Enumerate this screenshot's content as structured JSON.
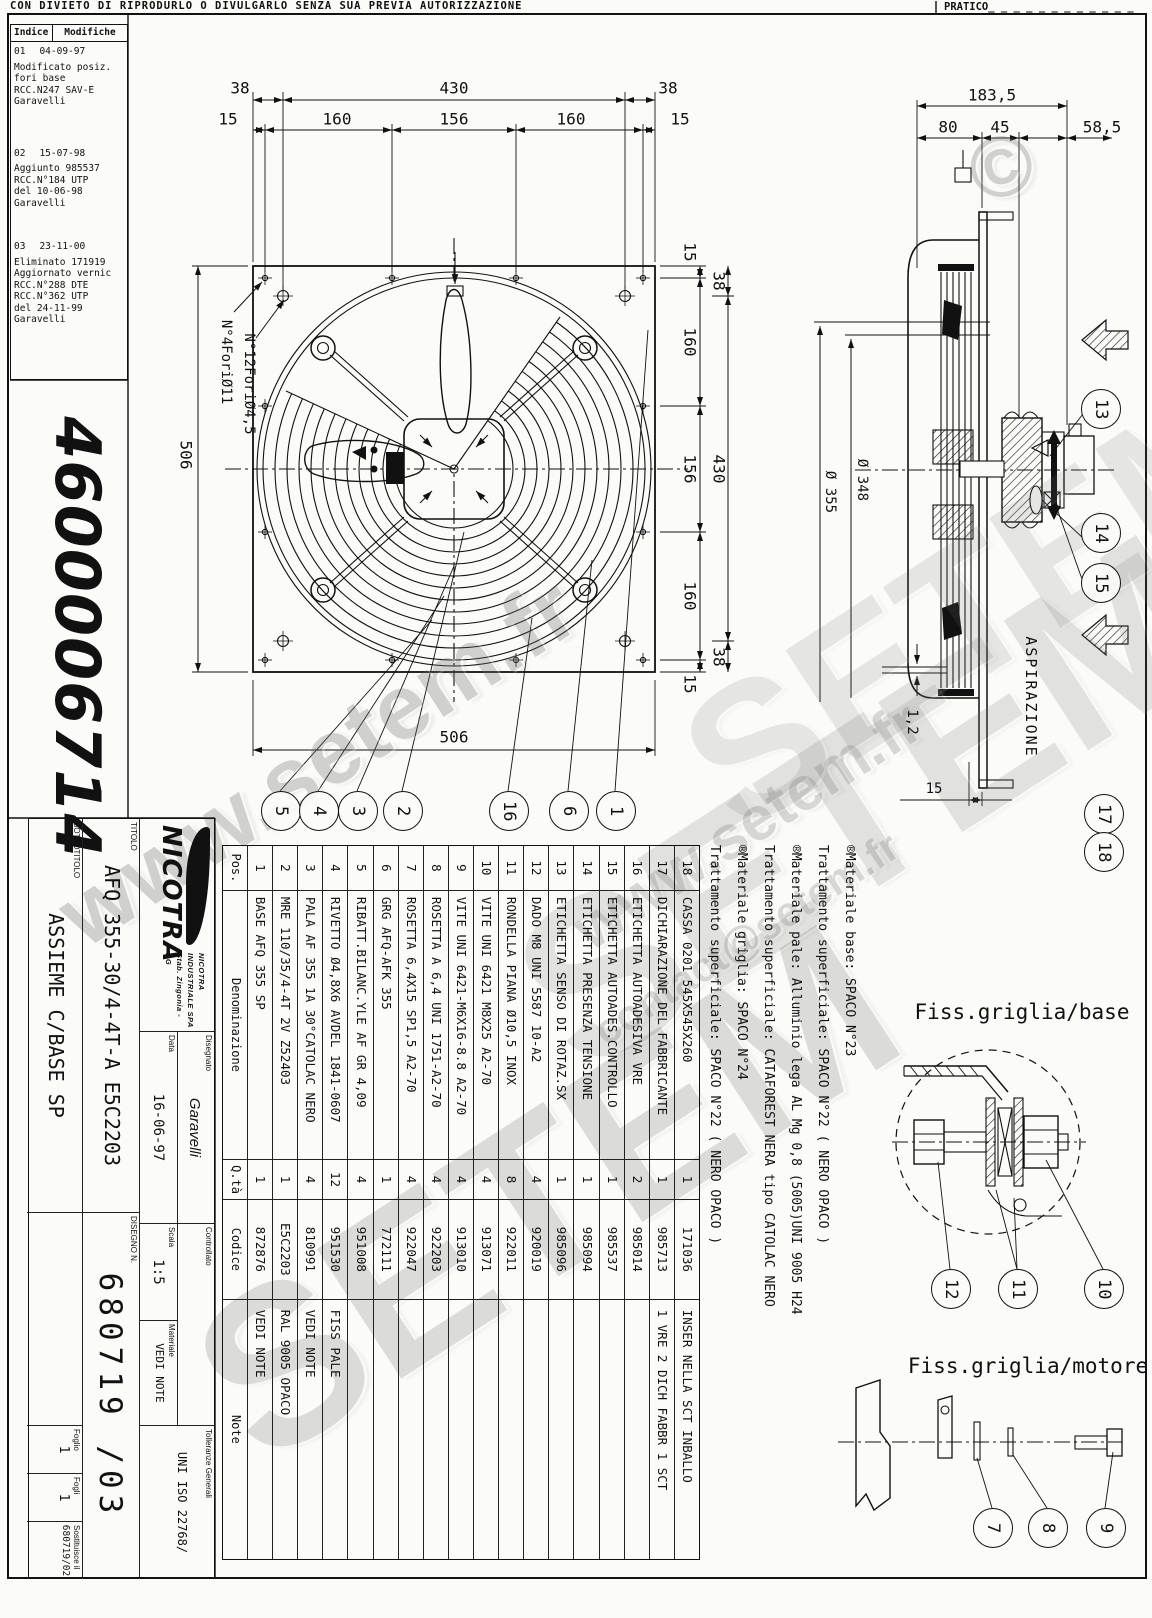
{
  "header": {
    "disclaimer": "CON DIVIETO DI RIPRODURLO O DIVULGARLO SENZA SUA PREVIA AUTORIZZAZIONE",
    "pratico": "PRATICO_ _ _ _ _ _ _ _ _ _ _ _"
  },
  "doc_number": "4600006714",
  "revision_table": {
    "col_index": "Indice",
    "col_mods": "Modifiche",
    "entries": [
      {
        "index": "01",
        "date": "04-09-97",
        "lines": [
          "Modificato posiz.",
          "fori base",
          "RCC.N247  SAV-E",
          "Garavelli"
        ]
      },
      {
        "index": "02",
        "date": "15-07-98",
        "lines": [
          "Aggiunto 985537",
          "RCC.N°184   UTP",
          "del 10-06-98",
          "Garavelli"
        ]
      },
      {
        "index": "03",
        "date": "23-11-00",
        "lines": [
          "Eliminato 171919",
          "Aggiornato vernic",
          "RCC.N°288    DTE",
          "RCC.N°362    UTP",
          "del 24-11-99",
          "Garavelli"
        ]
      }
    ]
  },
  "front_view": {
    "top_outer": [
      "38",
      "430",
      "38"
    ],
    "top_inner": [
      "15",
      "160",
      "156",
      "160",
      "15"
    ],
    "right_outer": [
      "38",
      "430",
      "38"
    ],
    "right_inner": [
      "15",
      "160",
      "156",
      "160",
      "15"
    ],
    "left_dim": "506",
    "bottom_dim": "506",
    "label_holes_big": "N°4ForiØ11",
    "label_holes_small": "N°12ForiØ4,5",
    "balloons": [
      "5",
      "4",
      "3",
      "2",
      "16",
      "6",
      "1"
    ]
  },
  "side_view": {
    "dim_overall": "183,5",
    "dim_chain": [
      "80",
      "45",
      "58,5"
    ],
    "dim_d348": "Ø 348",
    "dim_d355": "Ø 355",
    "dim_thickness": "1,2",
    "dim_offset": "15",
    "aspirazione": "ASPIRAZIONE",
    "balloons": [
      "13",
      "14",
      "15"
    ],
    "balloons_grille": [
      "17",
      "18"
    ]
  },
  "materials": {
    "lines": [
      "®Materiale base: SPACO N°23",
      "Trattamento superficiale: SPACO N°22 ( NERO OPACO )",
      "®Materiale pale: Alluminio lega AL Mg 0,8 (5005)UNI 9005 H24",
      "Trattamento superficiale: CATAFOREST NERA tipo CATOLAC NERO",
      "®Materiale griglia: SPACO N°24",
      "Trattamento superficiale: SPACO N°22 ( NERO OPACO )"
    ]
  },
  "parts_table": {
    "headers": {
      "pos": "Pos.",
      "den": "Denominazione",
      "qty": "Q.tà",
      "code": "Codice",
      "note": "Note"
    },
    "rows": [
      {
        "pos": "1",
        "den": "BASE AFQ 355 SP",
        "qty": "1",
        "code": "872876",
        "note": "VEDI NOTE"
      },
      {
        "pos": "2",
        "den": "MRE 110/35/4-4T 2V Z52403",
        "qty": "1",
        "code": "E5C2203",
        "note": "RAL 9005 OPACO"
      },
      {
        "pos": "3",
        "den": "PALA AF 355 1A 30°CATOLAC NERO",
        "qty": "4",
        "code": "810991",
        "note": "VEDI NOTE"
      },
      {
        "pos": "4",
        "den": "RIVETTO Ø4,8X6 AVDEL 1841-0607",
        "qty": "12",
        "code": "951530",
        "note": "FISS PALE"
      },
      {
        "pos": "5",
        "den": "RIBATT.BILANC.YLE AF GR 4,09",
        "qty": "4",
        "code": "951008",
        "note": ""
      },
      {
        "pos": "6",
        "den": "GRG AFQ-AFK 355",
        "qty": "1",
        "code": "772111",
        "note": ""
      },
      {
        "pos": "7",
        "den": "ROSETTA 6,4X15 SP1,5 A2-70",
        "qty": "4",
        "code": "922047",
        "note": ""
      },
      {
        "pos": "8",
        "den": "ROSETTA A 6,4 UNI 1751-A2-70",
        "qty": "4",
        "code": "922203",
        "note": ""
      },
      {
        "pos": "9",
        "den": "VITE UNI 6421-M6X16-8.8 A2-70",
        "qty": "4",
        "code": "913010",
        "note": ""
      },
      {
        "pos": "10",
        "den": "VITE UNI 6421 M8X25 A2-70",
        "qty": "4",
        "code": "913071",
        "note": ""
      },
      {
        "pos": "11",
        "den": "RONDELLA PIANA Ø10,5 INOX",
        "qty": "8",
        "code": "922011",
        "note": ""
      },
      {
        "pos": "12",
        "den": "DADO M8 UNI 5587 10-A2",
        "qty": "4",
        "code": "920019",
        "note": ""
      },
      {
        "pos": "13",
        "den": "ETICHETTA SENSO DI ROTAZ.SX",
        "qty": "1",
        "code": "985096",
        "note": ""
      },
      {
        "pos": "14",
        "den": "ETICHETTA PRESENZA TENSIONE",
        "qty": "1",
        "code": "985094",
        "note": ""
      },
      {
        "pos": "15",
        "den": "ETICHETTA AUTOADES.CONTROLLO",
        "qty": "1",
        "code": "985537",
        "note": ""
      },
      {
        "pos": "16",
        "den": "ETICHETTA AUTOADESIVA VRE",
        "qty": "2",
        "code": "985014",
        "note": ""
      },
      {
        "pos": "17",
        "den": "DICHIARAZIONE DEL FABBRICANTE",
        "qty": "1",
        "code": "985713",
        "note": "1 VRE 2 DICH FABBR 1 SCT"
      },
      {
        "pos": "18",
        "den": "CASSA 0201 545X545X260",
        "qty": "1",
        "code": "171036",
        "note": "INSER NELLA SCT INBALLO"
      }
    ]
  },
  "details": {
    "base_title": "Fiss.griglia/base",
    "base_balloons": [
      "12",
      "11",
      "10"
    ],
    "motor_title": "Fiss.griglia/motore",
    "motor_balloons": [
      "7",
      "8",
      "9"
    ]
  },
  "title_block": {
    "logo_word": "NICOTRA",
    "company_name": "NICOTRA INDUSTRIALE SPA",
    "company_sub": "Stab. Zingonia - BG",
    "titolo_label": "TITOLO",
    "titolo": "AFQ 355-30/4-4T-A E5C2203",
    "sottotitolo_label": "SOTTOTITOLO",
    "sottotitolo": "ASSIEME C/BASE SP",
    "disegnato_label": "Disegnato",
    "disegnato": "Garavelli",
    "data_label": "Data",
    "data": "16-06-97",
    "controllato_label": "Controllato",
    "scala_label": "Scala",
    "scala": "1:5",
    "materiale_label": "Materiale",
    "materiale": "VEDI NOTE",
    "tolleranze_label": "Tolleranze Generali",
    "tolleranze": "UNI ISO 22768/",
    "disegno_label": "DISEGNO N.",
    "disegno": "680719 /03",
    "foglio_label": "Foglio",
    "foglio": "1",
    "fogli_label": "Fogli",
    "fogli": "1",
    "sostituisce_label": "Sostituisce il",
    "sostituisce": "680719/02"
  },
  "watermarks": {
    "url": "www.setem.fr",
    "brand": "SETEM",
    "email": "contact@setem.fr",
    "copyright": "©"
  }
}
